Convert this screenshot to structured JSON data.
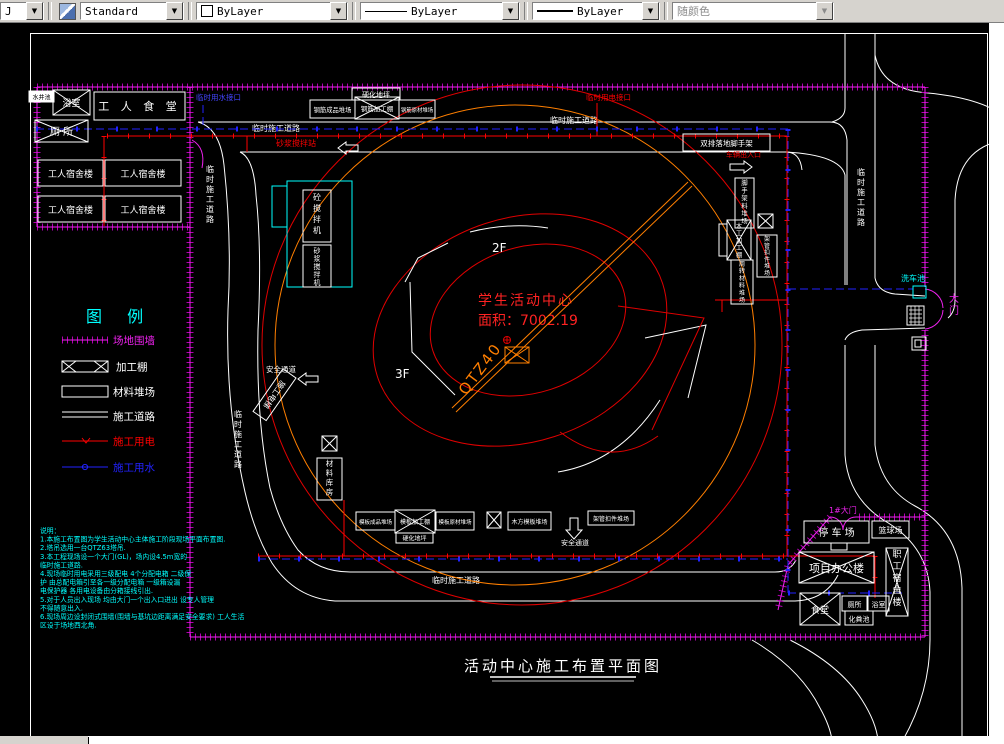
{
  "toolbar": {
    "layer_combo_partial": "J",
    "style_combo": "Standard",
    "color_combo": "ByLayer",
    "linetype_combo": "ByLayer",
    "lineweight_combo": "ByLayer",
    "plotstyle_combo": "随颜色"
  },
  "colors": {
    "fence": "#dd00dd",
    "power": "#ff0000",
    "water": "#2222ff",
    "crane": "#ff7f00",
    "highlight": "#00ffff",
    "line": "#ffffff"
  },
  "title": "活动中心施工布置平面图",
  "building": {
    "name": "学生活动中心",
    "area": "面积：7002.19",
    "crane_model": "QTZ40",
    "floor_2f": "2F",
    "floor_3f": "3F"
  },
  "labels": {
    "road": "临时施工道路",
    "water_tap": "临时用水接口",
    "power_tap": "临时用电接口",
    "well": "水井池",
    "bath": "浴室",
    "workers_canteen": "工 人 食 堂",
    "toilet": "厕  所",
    "worker_dorm": "工人宿舍楼",
    "mortar_station": "砂浆搅拌站",
    "hardened_ground": "硬化地坪",
    "rebar_finished_yard": "钢筋成品堆场",
    "rebar_shed": "钢筋加工棚",
    "rebar_raw_yard": "钢筋原材堆场",
    "concrete_mixer": "砼搅拌机",
    "mortar_mixer": "砂浆搅拌机",
    "scaffold": "双排落地脚手架",
    "vehicle_gate": "车辆出入口",
    "scaffold_mat_yard": "脚手架料堆场",
    "carpentry_shed": "木工加工棚",
    "coupler_yard": "架管扣件堆场",
    "turnover_mat_yard": "周转材料堆场",
    "safety_passage": "安全通道",
    "hoist": "施工电梯",
    "material_store": "材料库房",
    "formwork_finished_yard": "模板成品堆场",
    "formwork_shed": "模板加工棚",
    "formwork_raw_yard": "模板原材堆场",
    "timber_yard": "木方模板堆场",
    "gate1": "1#大门",
    "parking": "停 车 场",
    "basketball": "篮球场",
    "office": "项目办公楼",
    "staff_dorm": "职工宿舍楼",
    "canteen": "食堂",
    "toilet2": "厕所",
    "bath2": "浴室",
    "septic_tank": "化粪池",
    "wash_pool": "洗车池",
    "main_gate": "大门"
  },
  "legend": {
    "title": "图   例",
    "items": [
      {
        "label": "场地围墙",
        "color": "#dd00dd"
      },
      {
        "label": "加工棚",
        "color": "#ffffff"
      },
      {
        "label": "材料堆场",
        "color": "#ffffff"
      },
      {
        "label": "施工道路",
        "color": "#ffffff"
      },
      {
        "label": "施工用电",
        "color": "#ff0000"
      },
      {
        "label": "施工用水",
        "color": "#2222ff"
      }
    ]
  },
  "notes": {
    "lines": [
      "说明：",
      "1.本施工布置图为学生活动中心主体施工阶段现场平面布置图.",
      "2.塔吊选用一台QTZ63塔吊.",
      "3.本工程现场设一个大门(GL)，场内设4.5m宽的",
      "   临时施工道路.",
      "4.现场临时用电采用三级配电 4个分配电箱 二级保",
      "   护 由总配电箱引至各一级分配电箱 一级箱设漏",
      "   电保护器 各用电设备由分箱接线引出.",
      "5.对于人员出入现场 均由大门一个出入口进出 设专人管理",
      "   不得随意出入.",
      "6.现场周边设封闭式围墙(围墙与基坑边距离满足安全要求) 工人生活",
      "   区设于场地西北角."
    ]
  }
}
